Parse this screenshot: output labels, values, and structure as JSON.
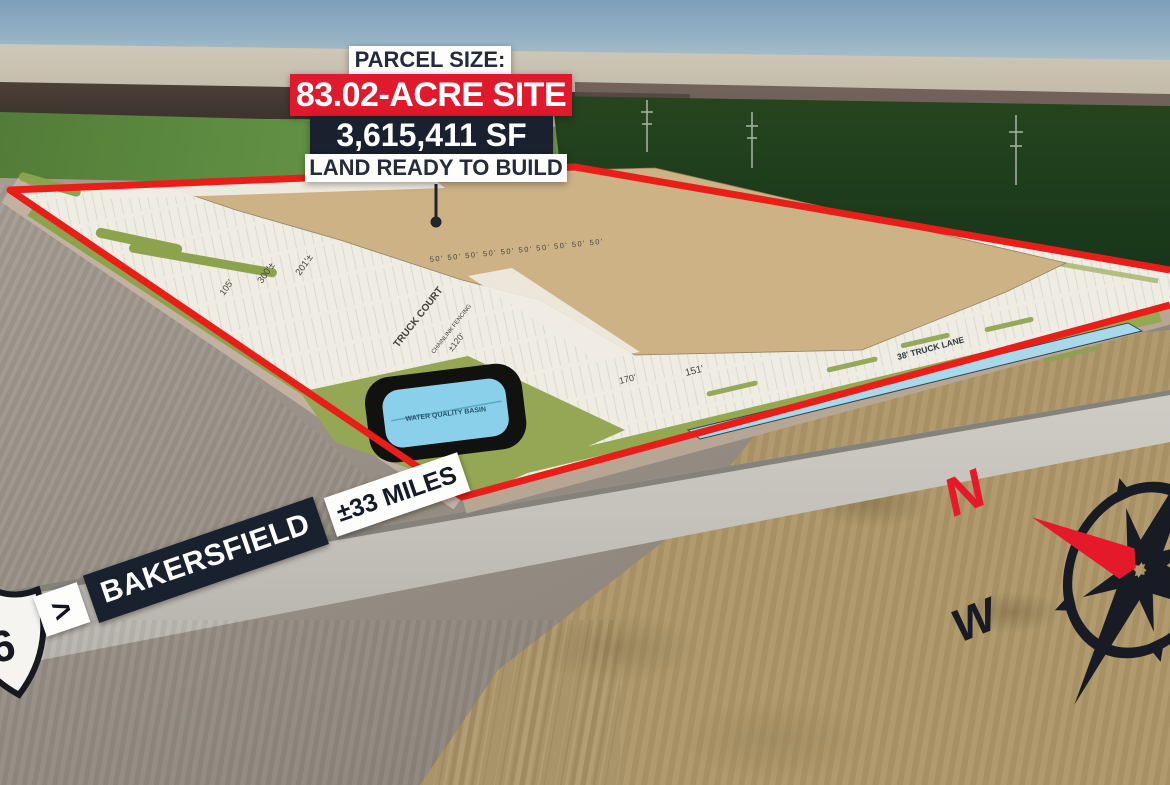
{
  "callout": {
    "heading": "PARCEL SIZE:",
    "acreage": "83.02-ACRE SITE",
    "square_feet": "3,615,411 SF",
    "subtext": "LAND READY TO BUILD"
  },
  "distance_banner": {
    "route_number": "6",
    "arrow": ">",
    "city": "BAKERSFIELD",
    "distance": "±33 MILES"
  },
  "site_plan": {
    "truck_court": "TRUCK COURT",
    "chainlink_fencing": "CHAINLINK FENCING",
    "water_basin": "WATER QUALITY BASIN",
    "truck_lane": "38' TRUCK LANE",
    "bay_spacing": "50' 50' 50' 50' 50' 50' 50' 50' 50' 50'",
    "dim_105": "105'",
    "dim_300": "300'±",
    "dim_201": "201'±",
    "dim_120": "±120'",
    "dim_151": "151'",
    "dim_170": "170'"
  },
  "compass": {
    "north_label": "N",
    "west_label": "W"
  },
  "colors": {
    "parcel_outline": "#e81e18",
    "callout_red": "#e0192d",
    "callout_navy": "#1a212e",
    "basin_blue": "#8bd0eb",
    "pad_tan": "#cdb285"
  }
}
